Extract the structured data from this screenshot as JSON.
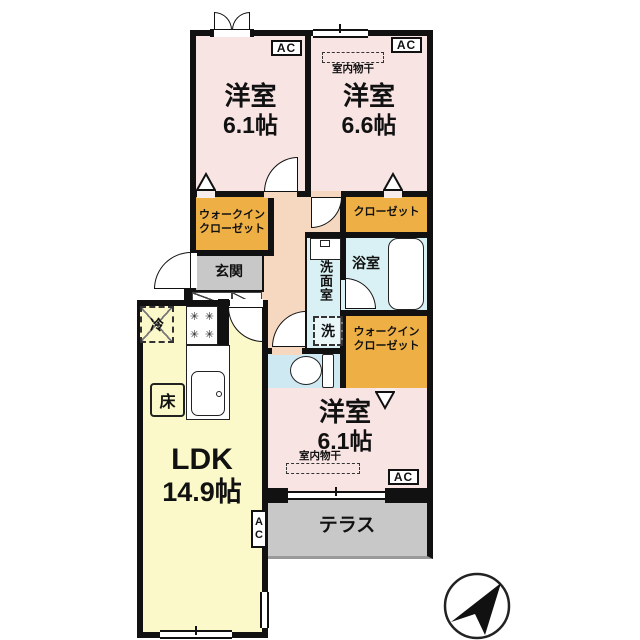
{
  "plan": {
    "room_top_left": {
      "label": "洋室",
      "size": "6.1帖",
      "ac": "AC"
    },
    "room_top_right": {
      "label": "洋室",
      "size": "6.6帖",
      "ac": "AC",
      "drying": "室内物干"
    },
    "room_bottom": {
      "label": "洋室",
      "size": "6.1帖",
      "ac": "AC",
      "drying": "室内物干"
    },
    "ldk": {
      "label": "LDK",
      "size": "14.9帖",
      "ac": "AC",
      "floor_heating": "床",
      "refrigerator": "冷"
    },
    "wic_top": {
      "line1": "ウォークイン",
      "line2": "クローゼット"
    },
    "wic_right": {
      "line1": "ウォークイン",
      "line2": "クローゼット"
    },
    "closet": {
      "label": "クローゼット"
    },
    "bath": {
      "label": "浴室"
    },
    "washroom": {
      "label": "洗面室",
      "washer": "洗"
    },
    "entrance": {
      "label": "玄関"
    },
    "terrace": {
      "label": "テラス"
    },
    "stove_burner_glyph": "✳"
  },
  "colors": {
    "wall": "#111111",
    "bedroom_pink": "#f9e4e4",
    "closet_orange": "#eeb045",
    "ldk_yellow": "#fbf9c9",
    "wet_area_cyan": "#d9f1f4",
    "toilet_blue": "#cfe9f2",
    "terrace_gray": "#c8c8c8",
    "corridor_peach": "#f5d8bf"
  }
}
